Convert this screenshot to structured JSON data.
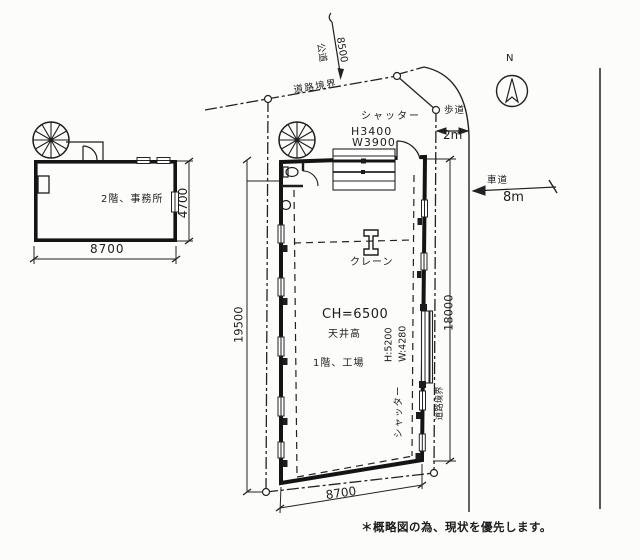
{
  "page": {
    "bg": "#fcfcfb",
    "ink": "#1d1d1d",
    "note": "＊概略図の為、現状を優先します。"
  },
  "office": {
    "room_label": "2階、事務所",
    "dim_width": "8700",
    "dim_height": "4700"
  },
  "factory": {
    "room_label": "1階、工場",
    "ceiling_height": "CH=6500",
    "ceiling_caption": "天井高",
    "crane_label": "クレーン",
    "dim_width": "8700",
    "dim_depth": "19500",
    "dim_east": "18000",
    "shutter_top": {
      "caption": "シャッター",
      "height": "H3400",
      "width": "W3900"
    },
    "shutter_east": {
      "caption": "シャッター",
      "height": "H:5200",
      "width": "W:4280"
    }
  },
  "site": {
    "boundary_top": "道路境界",
    "boundary_right": "道路境界",
    "public_road": "公道",
    "public_road_dim": "8500",
    "sidewalk": "歩道",
    "sidewalk_dim": "2m",
    "roadway": "車道",
    "roadway_dim": "8m",
    "north": "N"
  }
}
